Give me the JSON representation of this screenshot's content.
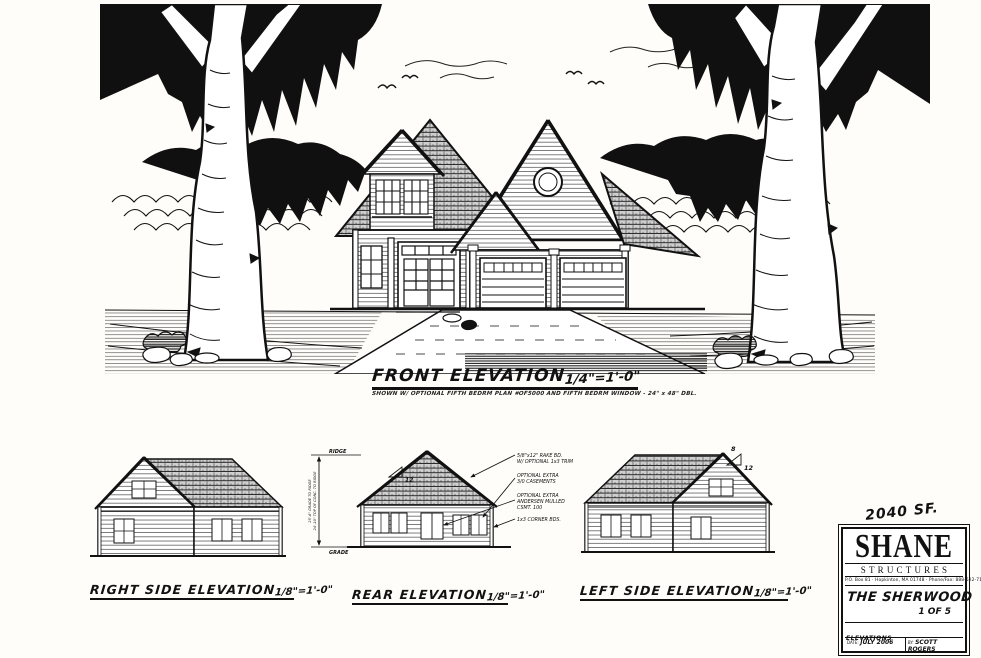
{
  "front": {
    "title": "FRONT ELEVATION",
    "scale": "1/4\"=1'-0\"",
    "note": "SHOWN W/ OPTIONAL FIFTH BEDRM PLAN #OF5000 AND FIFTH BEDRM WINDOW - 24\" x 48\" DBL."
  },
  "right_side": {
    "title": "RIGHT SIDE ELEVATION",
    "scale": "1/8\"=1'-0\""
  },
  "rear": {
    "title": "REAR ELEVATION",
    "scale": "1/8\"=1'-0\"",
    "ridge_label": "RIDGE",
    "grade_label": "GRADE",
    "dim_line1": "25'-6\" GRADE TO RIDGE",
    "dim_line2": "24'-10\" TOP OF CONC. TO RIDGE",
    "pitch": "12",
    "ann_lines": [
      "5/8\"x12\" RAKE BD.",
      "W/ OPTIONAL 1x3 TRIM",
      "OPTIONAL EXTRA",
      "3/0 CASEMENTS",
      "OPTIONAL EXTRA",
      "ANDERSEN MULLED",
      "CSMT. 100",
      "1x3 CORNER BDS."
    ]
  },
  "left_side": {
    "title": "LEFT SIDE ELEVATION",
    "scale": "1/8\"=1'-0\"",
    "pitch_rise": "8",
    "pitch_run": "12"
  },
  "title_block": {
    "area": "2040 SF.",
    "company_top": "SHANE",
    "company_bottom": "STRUCTURES",
    "address": "P.O. Box 81 · Hopkinton, MA 01748 · Phone/Fax: 888-522-7129",
    "plan_name": "THE SHERWOOD",
    "sheet": "1 OF 5",
    "drawing_type": "ELEVATIONS",
    "date_label": "DATE:",
    "date_value": "JULY 2006",
    "by_label": "BY:",
    "by_value": "SCOTT ROGERS"
  },
  "colors": {
    "ink": "#111111",
    "paper": "#fffdfa"
  }
}
